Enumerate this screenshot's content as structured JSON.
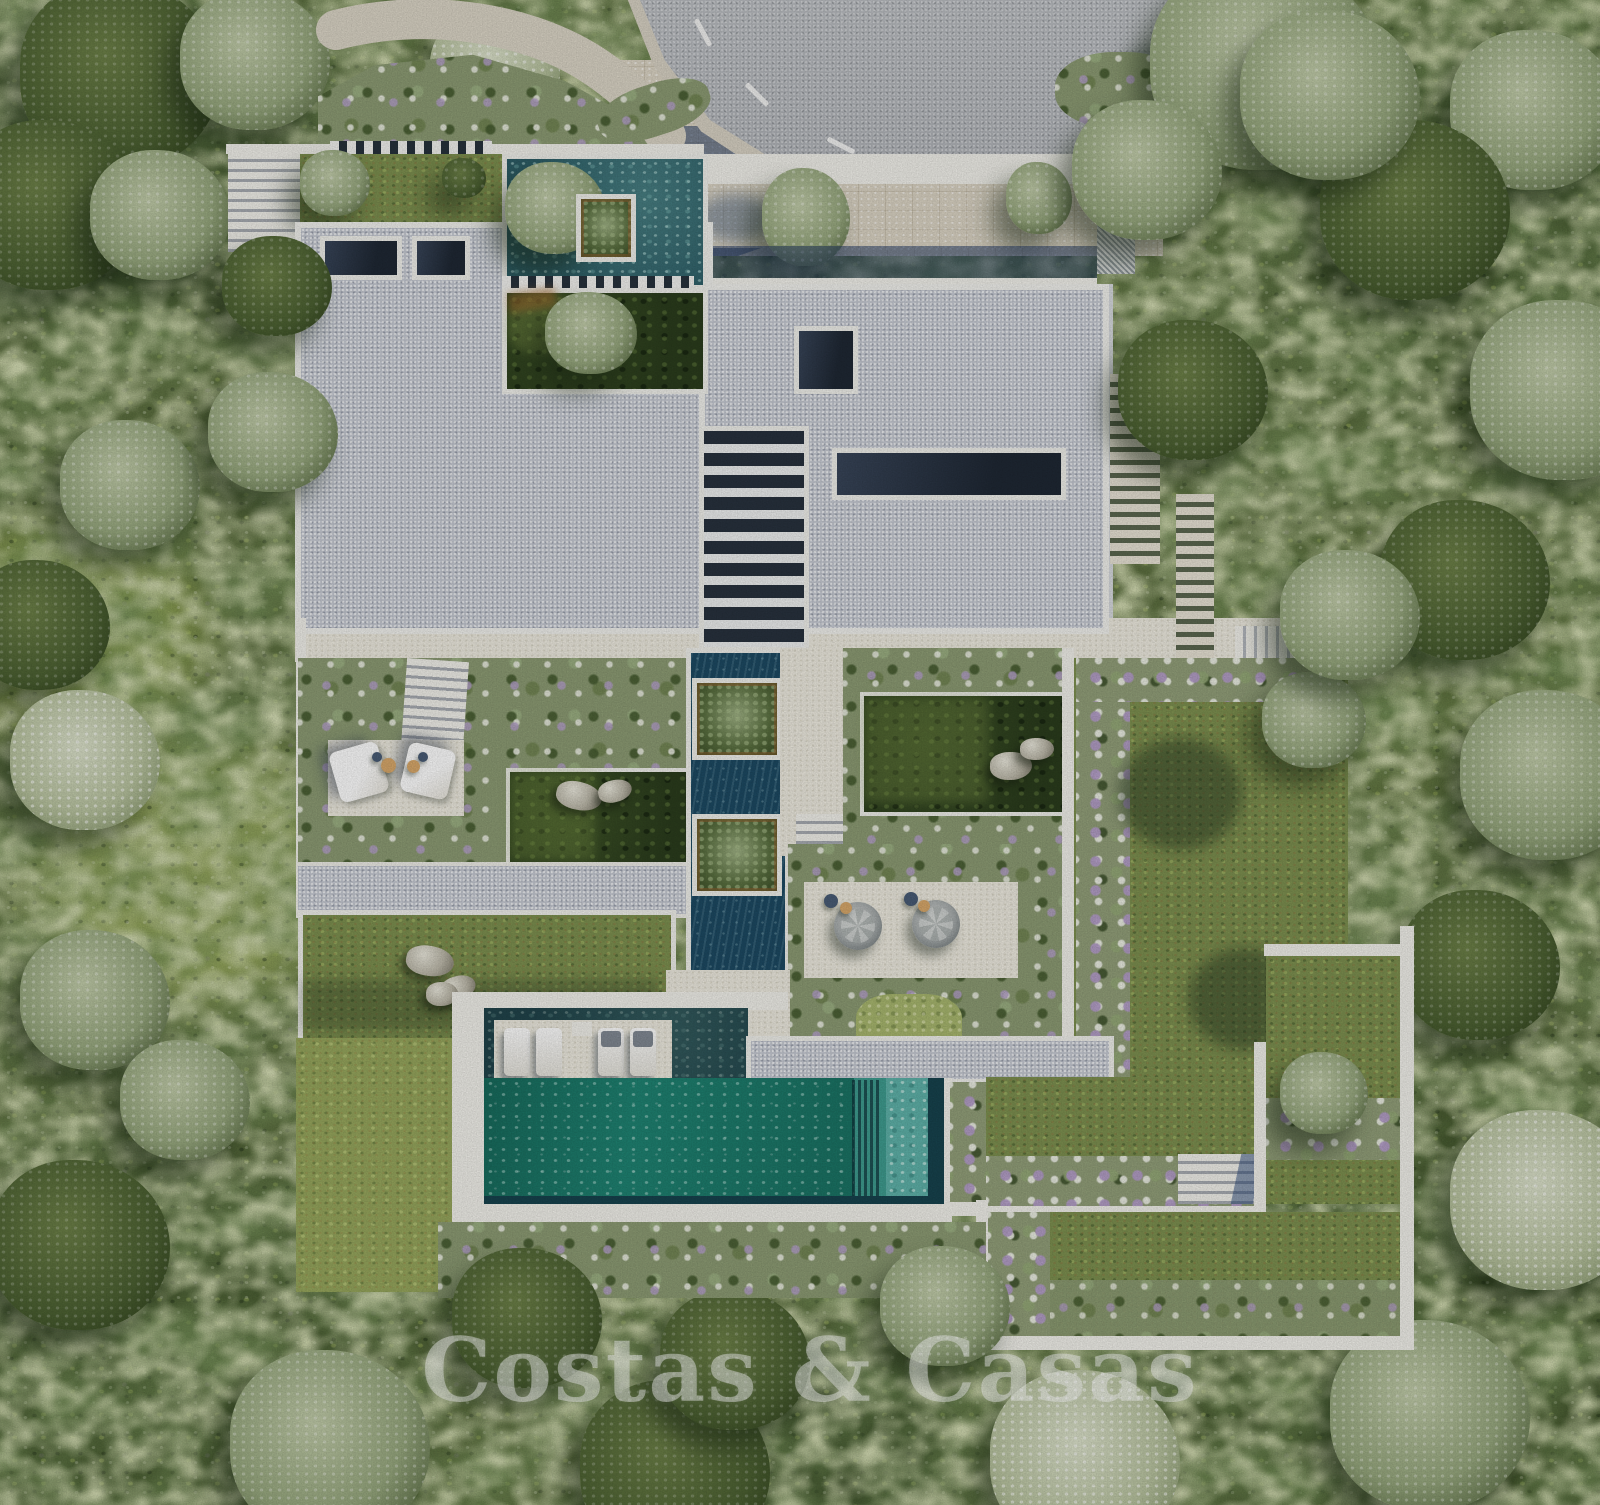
{
  "scene": {
    "alt": "Aerial render of a modern flat-roofed luxury villa with gravel roof, interior courtyards, water features, landscaped gardens and an emerald infinity pool, surrounded by dense Mediterranean forest beside a curved asphalt road",
    "watermark": "Costas & Casas"
  },
  "watermark": {
    "text": "Costas & Casas"
  },
  "colors": {
    "forest": "#5d7040",
    "forest-dark": "#3c4f29",
    "sage": "#a3b183",
    "road": "#b6b9bd",
    "beige": "#dcd5c5",
    "white": "#f3f2ec",
    "roof": "#c6cad3",
    "skylight": "#232c38",
    "pool": "#1f8473",
    "pool-shallow": "#5fb3aa",
    "channel": "#1d4a63",
    "court-water": "#2e5f68",
    "lawn": "#7e9150",
    "moss": "#a9b86f",
    "flower": "#b5a2c9",
    "shadow": "#24406c"
  }
}
